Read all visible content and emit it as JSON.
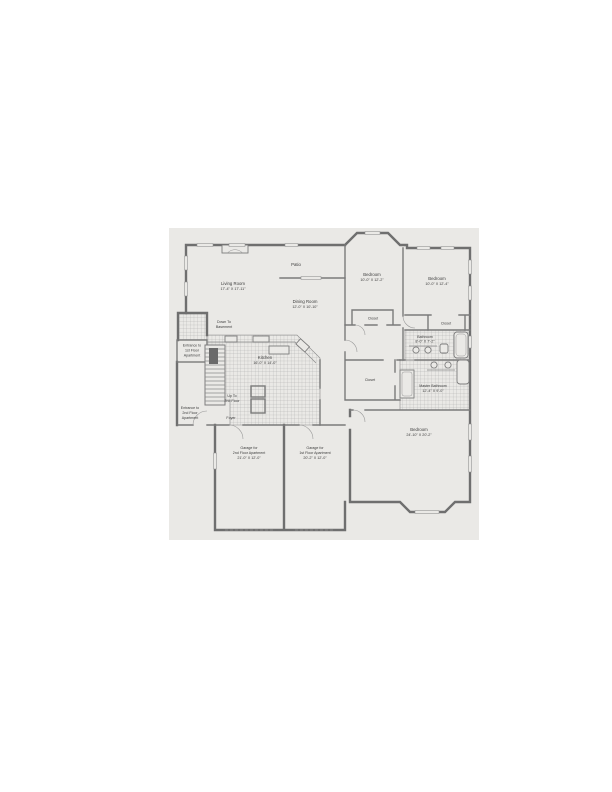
{
  "page": {
    "background": "#ffffff",
    "paper_color": "#eae9e6",
    "wall_color": "#6f6f6f",
    "text_color": "#3c3c3c"
  },
  "labels": {
    "living_room": [
      "Living Room",
      "17'-4\" X 17'-11\""
    ],
    "patio": [
      "Patio"
    ],
    "dining_room": [
      "Dining Room",
      "12'-0\" X 10'-10\""
    ],
    "bedroom_center": [
      "Bedroom",
      "10'-0\" X 12'-2\""
    ],
    "bedroom_right": [
      "Bedroom",
      "10'-0\" X 12'-4\""
    ],
    "closet_center": [
      "Closet"
    ],
    "closet_right": [
      "Closet"
    ],
    "closet_hall": [
      "Closet"
    ],
    "bathroom": [
      "Bathroom",
      "8'-0\" X 7'-2\""
    ],
    "master_bathroom": [
      "Master Bathroom",
      "12'-4\" X 9'-0\""
    ],
    "kitchen": [
      "Kitchen",
      "16'-0\" X 14'-0\""
    ],
    "down_to_basement": [
      "Down To",
      "Basement"
    ],
    "entrance_1st": [
      "Entrance to",
      "1st Floor",
      "Apartment"
    ],
    "up_to_2nd": [
      "Up To",
      "2nd Floor"
    ],
    "foyer": [
      "Foyer"
    ],
    "entrance_2nd": [
      "Entrance to",
      "2nd Floor",
      "Apartment"
    ],
    "garage_2nd": [
      "Garage for",
      "2nd Floor Apartment",
      "21'-0\" X 12'-0\""
    ],
    "garage_1st": [
      "Garage for",
      "1st Floor Apartment",
      "20'-2\" X 12'-0\""
    ],
    "bedroom_master": [
      "Bedroom",
      "24'-10\" X 20'-2\""
    ]
  }
}
